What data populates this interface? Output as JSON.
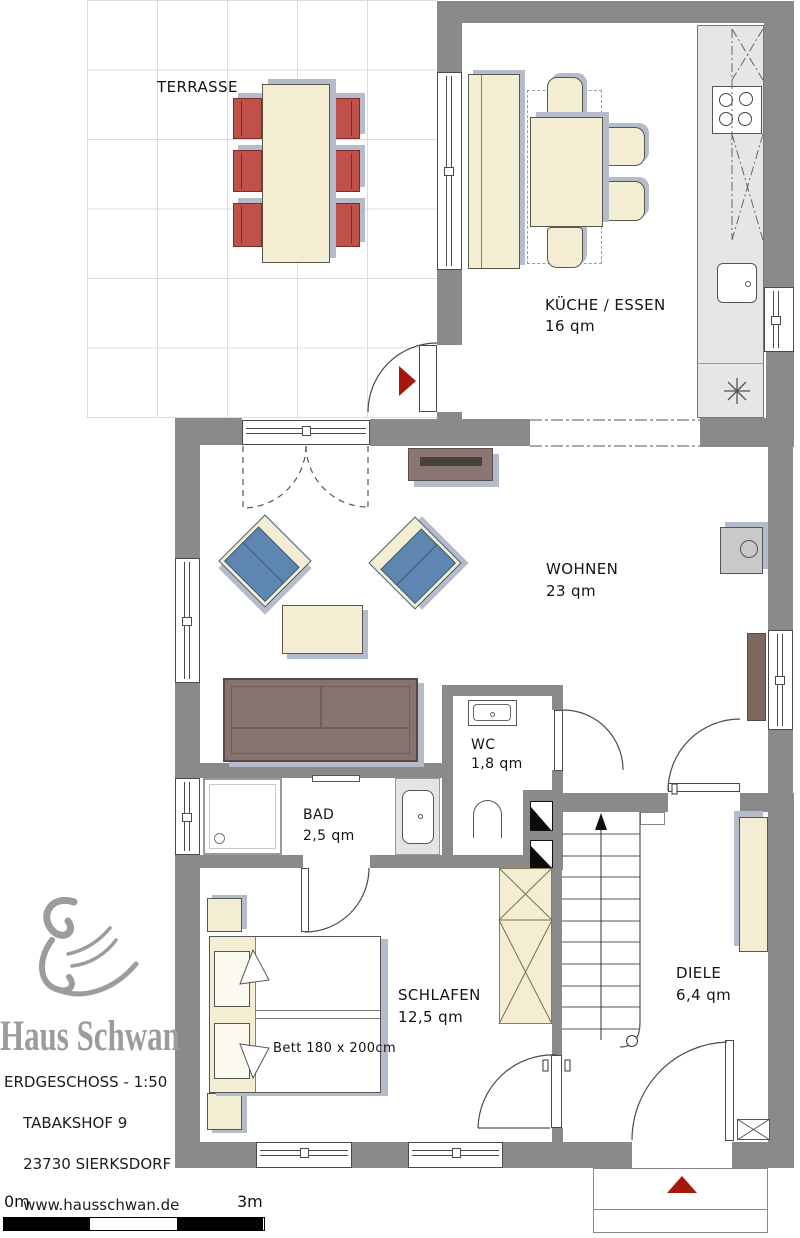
{
  "rooms": {
    "terrasse": {
      "label": "TERRASSE"
    },
    "kueche": {
      "label": "KÜCHE / ESSEN",
      "area": "16 qm"
    },
    "wohnen": {
      "label": "WOHNEN",
      "area": "23 qm"
    },
    "wc": {
      "label": "WC",
      "area": "1,8 qm"
    },
    "bad": {
      "label": "BAD",
      "area": "2,5 qm"
    },
    "schlafen": {
      "label": "SCHLAFEN",
      "area": "12,5 qm",
      "bed_note": "Bett 180 x 200cm"
    },
    "diele": {
      "label": "DIELE",
      "area": "6,4 qm"
    }
  },
  "branding": {
    "name": "Haus Schwan",
    "logo": "swan-icon"
  },
  "address": {
    "floor_scale": "ERDGESCHOSS - 1:50",
    "street": "TABAKSHOF 9",
    "city": "23730 SIERKSDORF",
    "website": "www.hausschwan.de",
    "copyright": "©Dietrich"
  },
  "scale_bar": {
    "start_label": "0m",
    "end_label": "3m"
  },
  "colors": {
    "wall": "#8a8a8a",
    "grid": "#dcdcdc",
    "cream": "#f3edd3",
    "red_chair": "#c0504a",
    "blue_chair": "#5d87b0",
    "sofa": "#867371",
    "tv_board": "#8b7672",
    "sideboard": "#7d685e",
    "shadow": "#b4bbca",
    "arrow_red": "#a6170c",
    "counter": "#e6e6e6"
  }
}
